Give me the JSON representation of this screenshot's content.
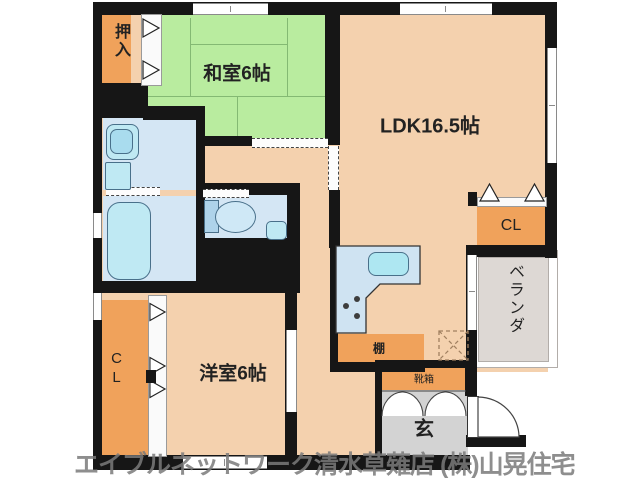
{
  "watermark": "エイブルネットワーク清水草薙店 (株)山晃住宅",
  "rooms": {
    "washitsu": {
      "label": "和室6帖"
    },
    "ldk": {
      "label": "LDK16.5帖"
    },
    "yoshitsu": {
      "label": "洋室6帖"
    },
    "oshiire": {
      "label": "押入"
    },
    "closet_left": {
      "label": "CL"
    },
    "closet_right": {
      "label": "CL"
    },
    "veranda": {
      "label": "ベランダ"
    },
    "genkan": {
      "label": "玄"
    },
    "shelf": {
      "label": "棚"
    },
    "shoe_box": {
      "label": "靴箱"
    }
  },
  "colors": {
    "wall": "#161616",
    "room_peach": "#f4d1ae",
    "tatami_green": "#b9ec9f",
    "closet_orange": "#f0a25b",
    "wet_area_blue": "#d4e6f4",
    "fixture_blue": "#bfe9f3",
    "genkan_gray": "#d3d3d3",
    "veranda_gray": "#ddd8d4",
    "watermark_gray": "#7a7a7a"
  }
}
